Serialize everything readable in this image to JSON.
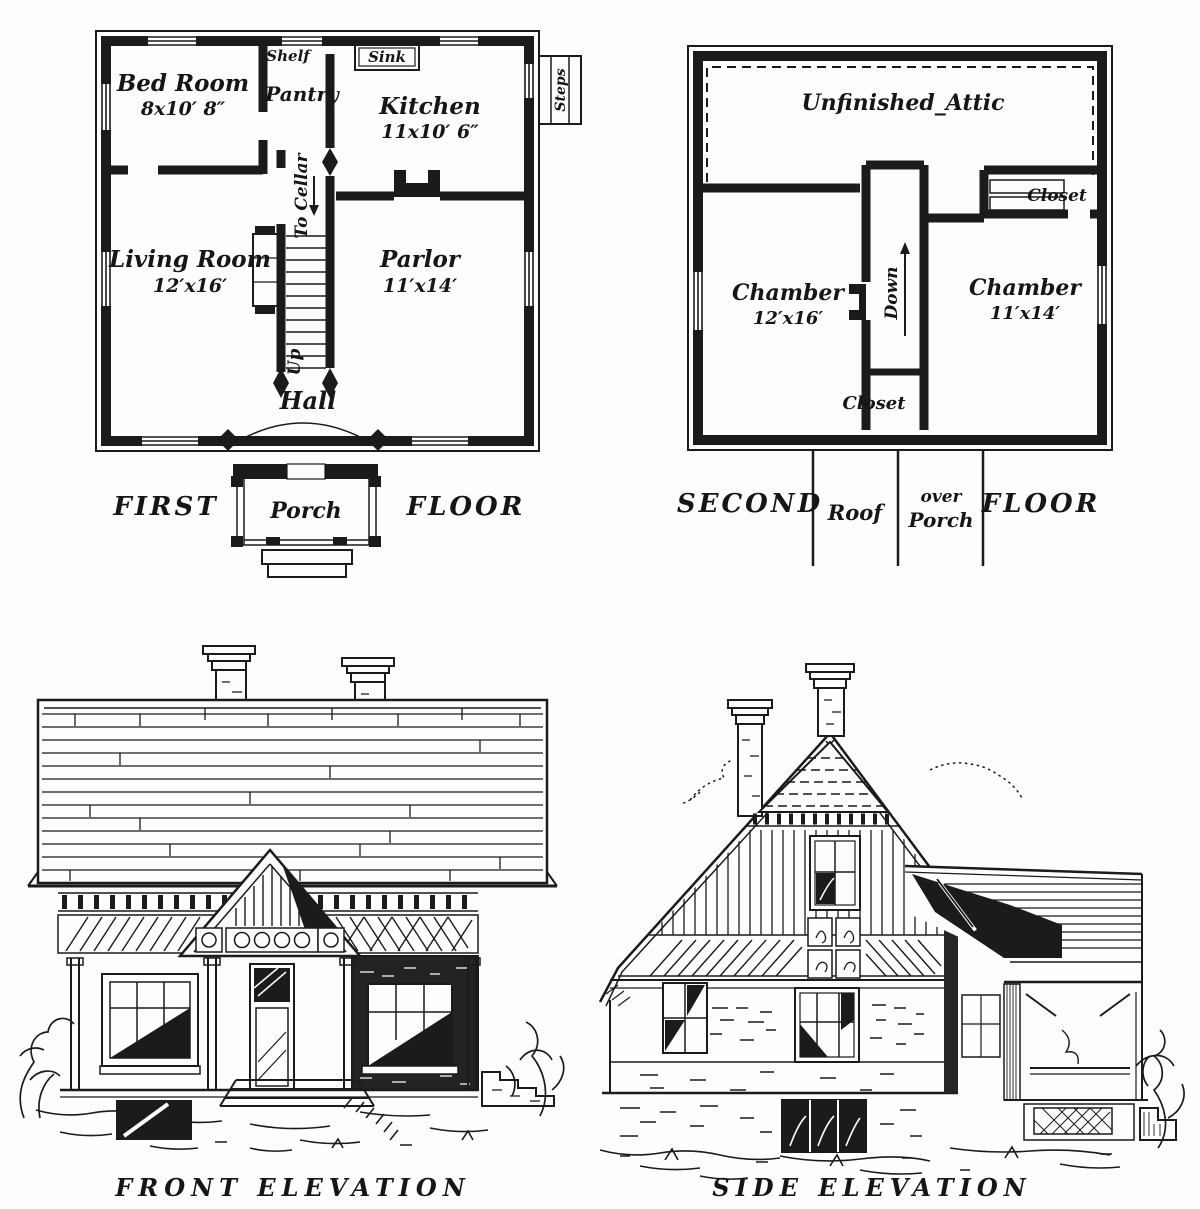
{
  "colors": {
    "paper": "#fdfdfb",
    "ink": "#1b1b1b"
  },
  "first_floor_plan": {
    "bed_room": {
      "name": "Bed Room",
      "size": "8x10′ 8″"
    },
    "shelf": "Shelf",
    "sink": "Sink",
    "pantry": "Pantry",
    "kitchen": {
      "name": "Kitchen",
      "size": "11x10′ 6″"
    },
    "steps": "Steps",
    "to_cellar": "To Cellar",
    "living_room": {
      "name": "Living Room",
      "size": "12′x16′"
    },
    "parlor": {
      "name": "Parlor",
      "size": "11′x14′"
    },
    "up": "Up",
    "hall": "Hall",
    "porch": "Porch",
    "caption_left": "FIRST",
    "caption_right": "FLOOR"
  },
  "second_floor_plan": {
    "attic": "Unfinished_Attic",
    "closet_upper": "Closet",
    "chamber_left": {
      "name": "Chamber",
      "size": "12′x16′"
    },
    "down": "Down",
    "chamber_right": {
      "name": "Chamber",
      "size": "11′x14′"
    },
    "closet_lower": "Closet",
    "caption_left": "SECOND",
    "roof_label": "Roof",
    "over_label_top": "over",
    "over_label_bottom": "Porch",
    "caption_right": "FLOOR"
  },
  "front_elevation": {
    "caption": "FRONT ELEVATION"
  },
  "side_elevation": {
    "caption": "SIDE ELEVATION"
  }
}
